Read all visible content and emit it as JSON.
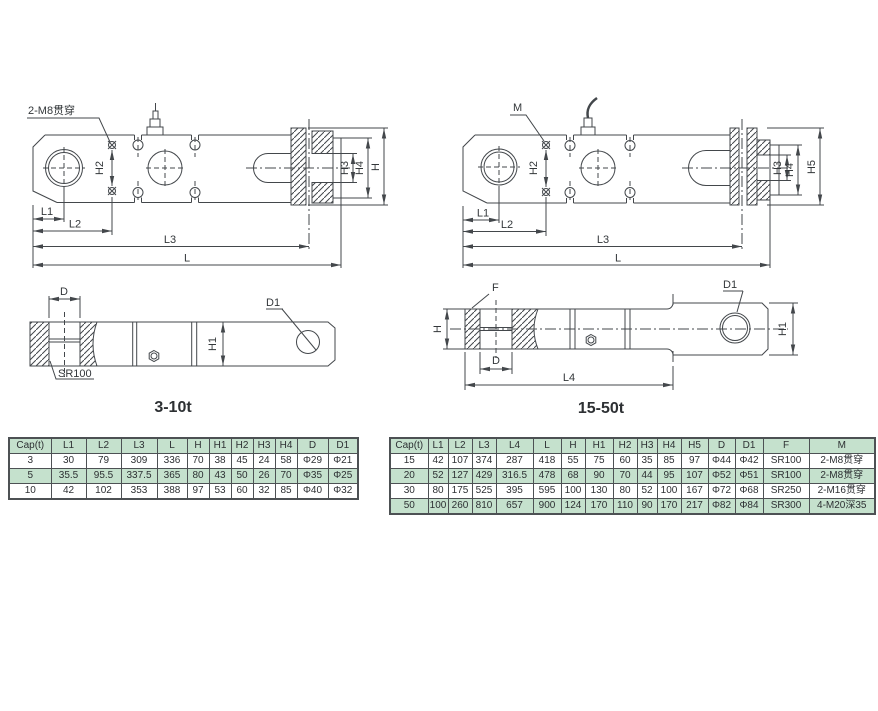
{
  "colors": {
    "row_green": "#c5e1cd",
    "table_border": "#4d5154",
    "line": "#43474b"
  },
  "drawings": {
    "side_small": {
      "thread_label": "2-M8贯穿",
      "h2": "H2",
      "h3": "H3",
      "h4": "H4",
      "h": "H",
      "l1": "L1",
      "l2": "L2",
      "l3": "L3",
      "l": "L"
    },
    "side_large": {
      "thread_label": "M",
      "h2": "H2",
      "h3": "H3",
      "h4": "H4",
      "h5": "H5",
      "l1": "L1",
      "l2": "L2",
      "l3": "L3",
      "l": "L"
    },
    "top_small": {
      "title": "3-10t",
      "d": "D",
      "d1": "D1",
      "h1": "H1",
      "sr": "SR100"
    },
    "top_large": {
      "title": "15-50t",
      "f": "F",
      "d": "D",
      "d1": "D1",
      "h": "H",
      "h1": "H1",
      "l4": "L4"
    }
  },
  "tables": {
    "small": {
      "headers": [
        "Cap(t)",
        "L1",
        "L2",
        "L3",
        "L",
        "H",
        "H1",
        "H2",
        "H3",
        "H4",
        "D",
        "D1"
      ],
      "rows": [
        [
          "3",
          "30",
          "79",
          "309",
          "336",
          "70",
          "38",
          "45",
          "24",
          "58",
          "Φ29",
          "Φ21"
        ],
        [
          "5",
          "35.5",
          "95.5",
          "337.5",
          "365",
          "80",
          "43",
          "50",
          "26",
          "70",
          "Φ35",
          "Φ25"
        ],
        [
          "10",
          "42",
          "102",
          "353",
          "388",
          "97",
          "53",
          "60",
          "32",
          "85",
          "Φ40",
          "Φ32"
        ]
      ]
    },
    "large": {
      "headers": [
        "Cap(t)",
        "L1",
        "L2",
        "L3",
        "L4",
        "L",
        "H",
        "H1",
        "H2",
        "H3",
        "H4",
        "H5",
        "D",
        "D1",
        "F",
        "M"
      ],
      "rows": [
        [
          "15",
          "42",
          "107",
          "374",
          "287",
          "418",
          "55",
          "75",
          "60",
          "35",
          "85",
          "97",
          "Φ44",
          "Φ42",
          "SR100",
          "2-M8贯穿"
        ],
        [
          "20",
          "52",
          "127",
          "429",
          "316.5",
          "478",
          "68",
          "90",
          "70",
          "44",
          "95",
          "107",
          "Φ52",
          "Φ51",
          "SR100",
          "2-M8贯穿"
        ],
        [
          "30",
          "80",
          "175",
          "525",
          "395",
          "595",
          "100",
          "130",
          "80",
          "52",
          "100",
          "167",
          "Φ72",
          "Φ68",
          "SR250",
          "2-M16贯穿"
        ],
        [
          "50",
          "100",
          "260",
          "810",
          "657",
          "900",
          "124",
          "170",
          "110",
          "90",
          "170",
          "217",
          "Φ82",
          "Φ84",
          "SR300",
          "4-M20深35"
        ]
      ]
    }
  }
}
